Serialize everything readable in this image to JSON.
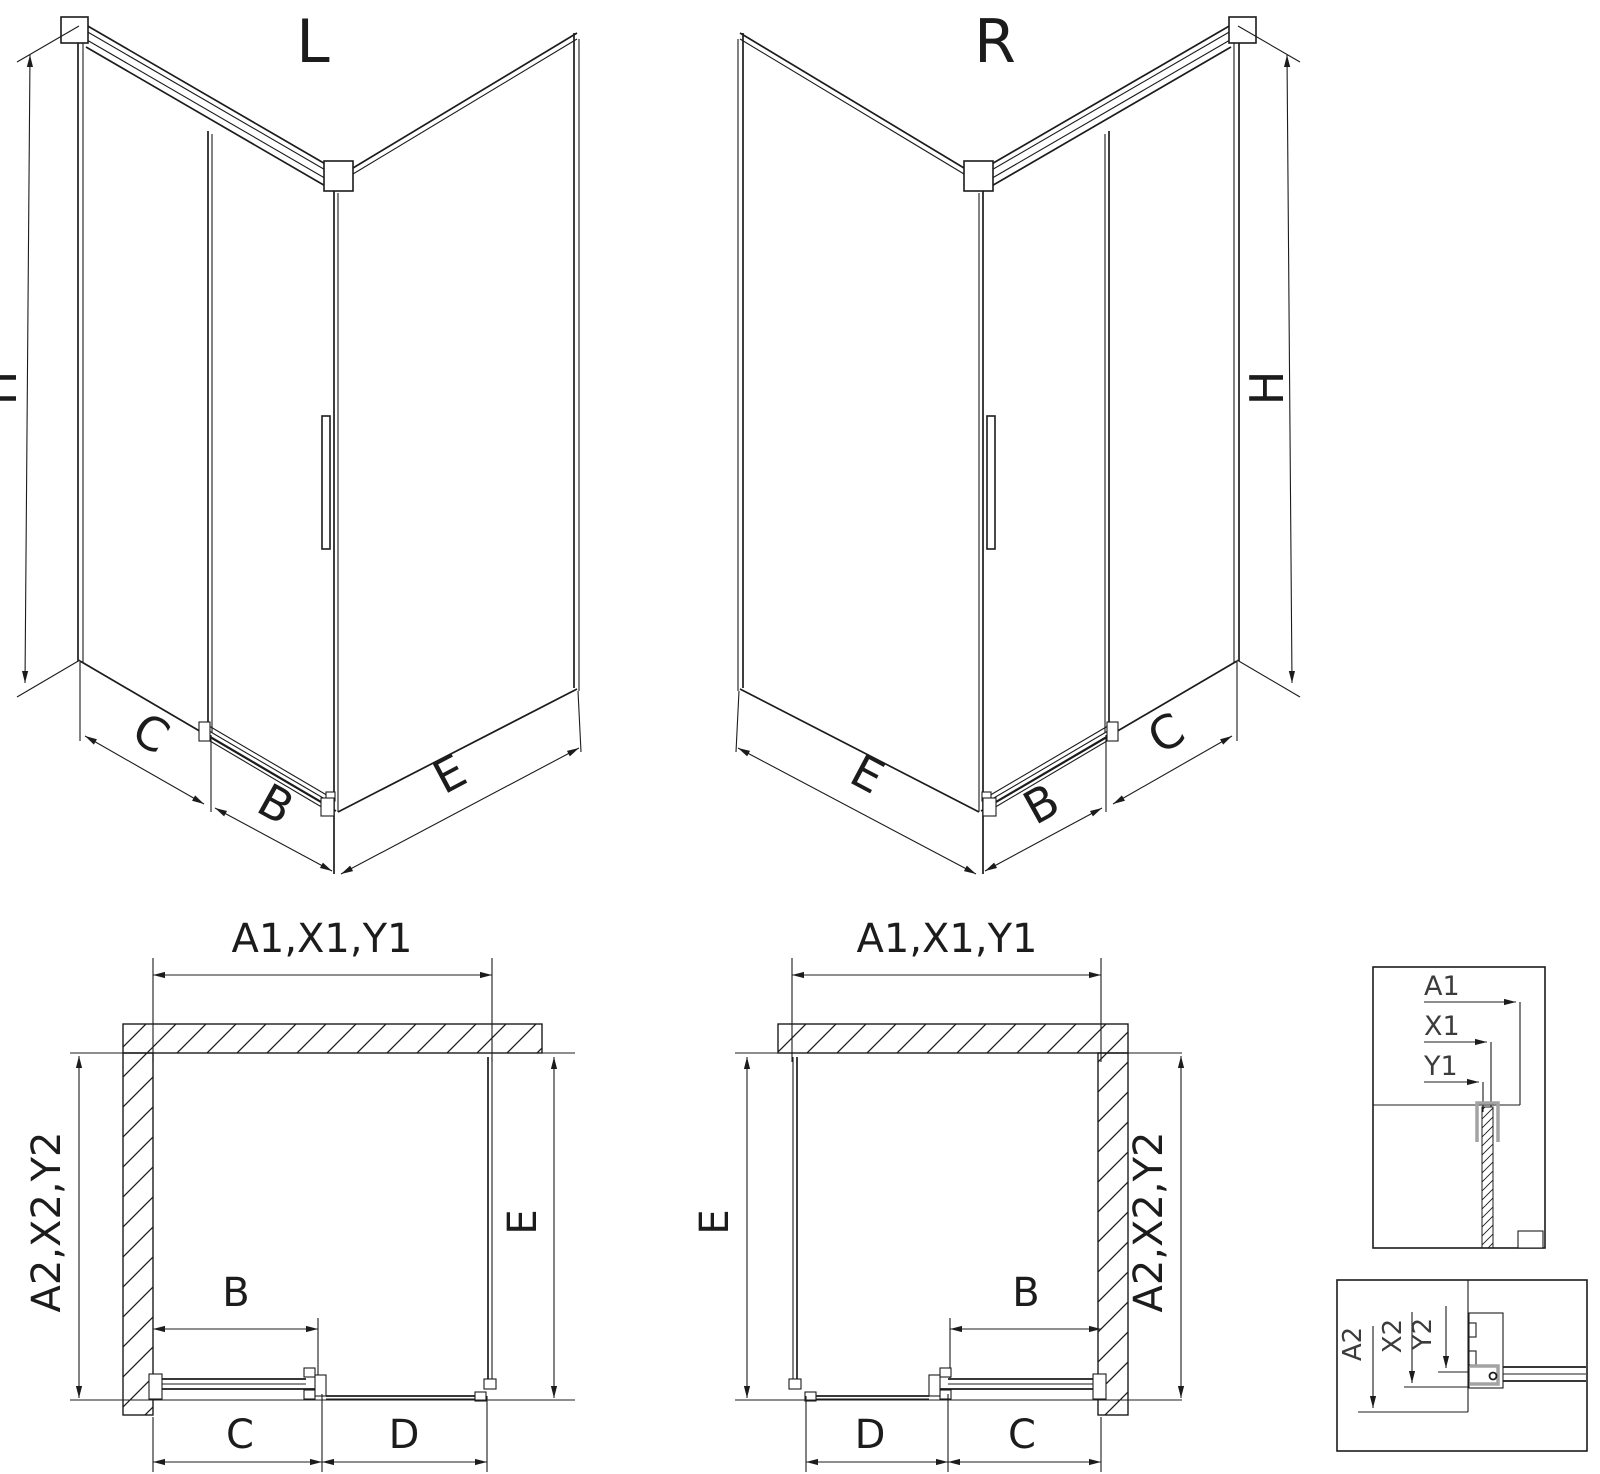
{
  "views": {
    "iso_left": {
      "variant": "L",
      "height_dim": "H",
      "panel_dim": "C",
      "door_dim": "B",
      "side_dim": "E"
    },
    "iso_right": {
      "variant": "R",
      "height_dim": "H",
      "panel_dim": "C",
      "door_dim": "B",
      "side_dim": "E"
    },
    "plan_left": {
      "width_dim": "A1,X1,Y1",
      "depth_dim": "A2,X2,Y2",
      "side_dim": "E",
      "door_dim": "B",
      "opening_dim": "C",
      "panel_dim": "D"
    },
    "plan_right": {
      "width_dim": "A1,X1,Y1",
      "depth_dim": "A2,X2,Y2",
      "side_dim": "E",
      "door_dim": "B",
      "opening_dim": "C",
      "panel_dim": "D"
    },
    "detail_top": {
      "labels": [
        "A1",
        "X1",
        "Y1"
      ]
    },
    "detail_bottom": {
      "labels": [
        "A2",
        "X2",
        "Y2"
      ]
    }
  },
  "colors": {
    "line": "#1c1c1c",
    "detail_text": "#3c3c3c",
    "profile_gray": "#a3a3a3",
    "background": "#ffffff"
  }
}
